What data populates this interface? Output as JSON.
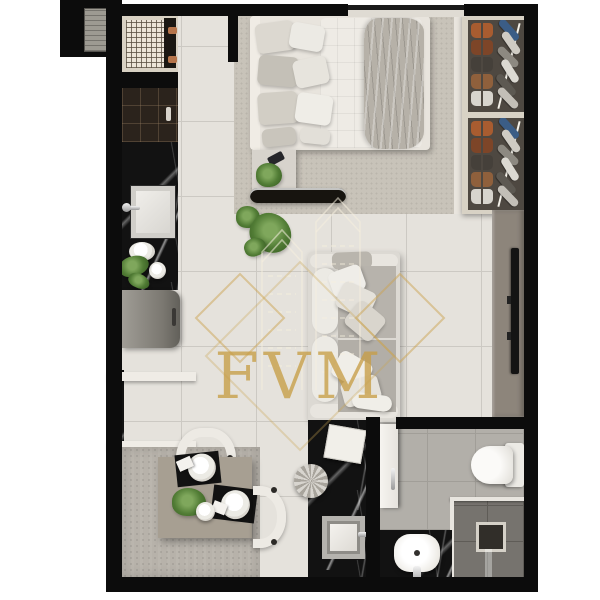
{
  "watermark": {
    "text": "FVM"
  },
  "palette": {
    "wall_black": "#0c0c0c",
    "floor_tile": "#e5e2dc",
    "tile_grout": "#ccc9c3",
    "bedroom_carpet": "#c8c3b9",
    "dining_rug": "#b7b2aa",
    "black_marble": "#121212",
    "table_taupe": "#a79f92",
    "tv_panel_taupe": "#8d857b",
    "bathroom_floor": "#b2afa9",
    "shower_tile": "#76736e",
    "watermark_gold": "#c9a44d",
    "plant_green": "#517c35",
    "copper_pipe": "#b5744a",
    "white_fixture": "#f2f0ec"
  }
}
